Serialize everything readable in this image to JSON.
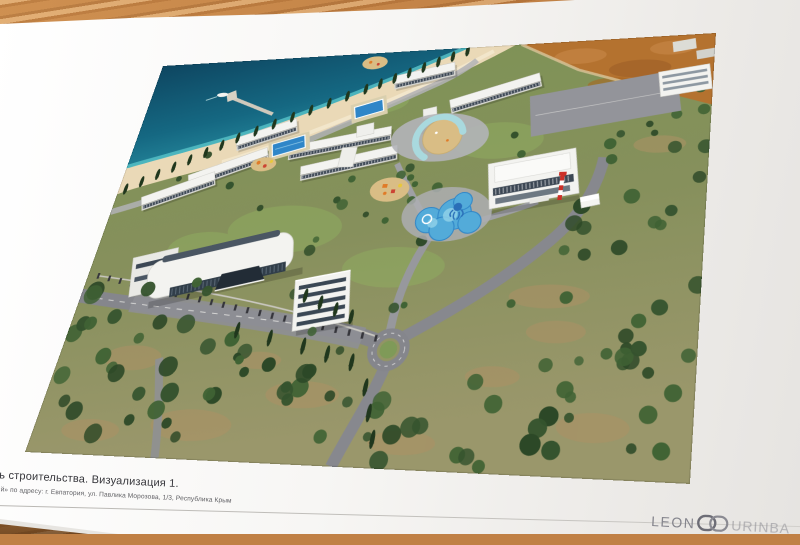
{
  "caption": {
    "title": "дь строительства. Визуализация 1.",
    "address": "ный» по адресу: г. Евпатория, ул. Павлика Морозова, 1/3, Республика Крым"
  },
  "brand": {
    "prefix": "LEON",
    "suffix": "URINBA"
  },
  "palette": {
    "wood": "#c08045",
    "page": "#f7f6f4",
    "sea_deep": "#12506b",
    "sea_shallow": "#35a2b0",
    "beach": "#ead9b7",
    "lawn": "#7e9157",
    "tree": "#2f4d2a",
    "road": "#85868c",
    "path": "#a5a6ab",
    "building": "#f3f3f0",
    "window": "#3c4754",
    "pool": "#2f86c8",
    "kids_pool": "#53abd9",
    "crescent_pool": "#a9d9de",
    "sand_play": "#d9bd85",
    "dirt_field": "#b4722f",
    "playground": "#e07b28",
    "tower_red": "#cc2f27",
    "house_gray": "#cfcdc6"
  }
}
